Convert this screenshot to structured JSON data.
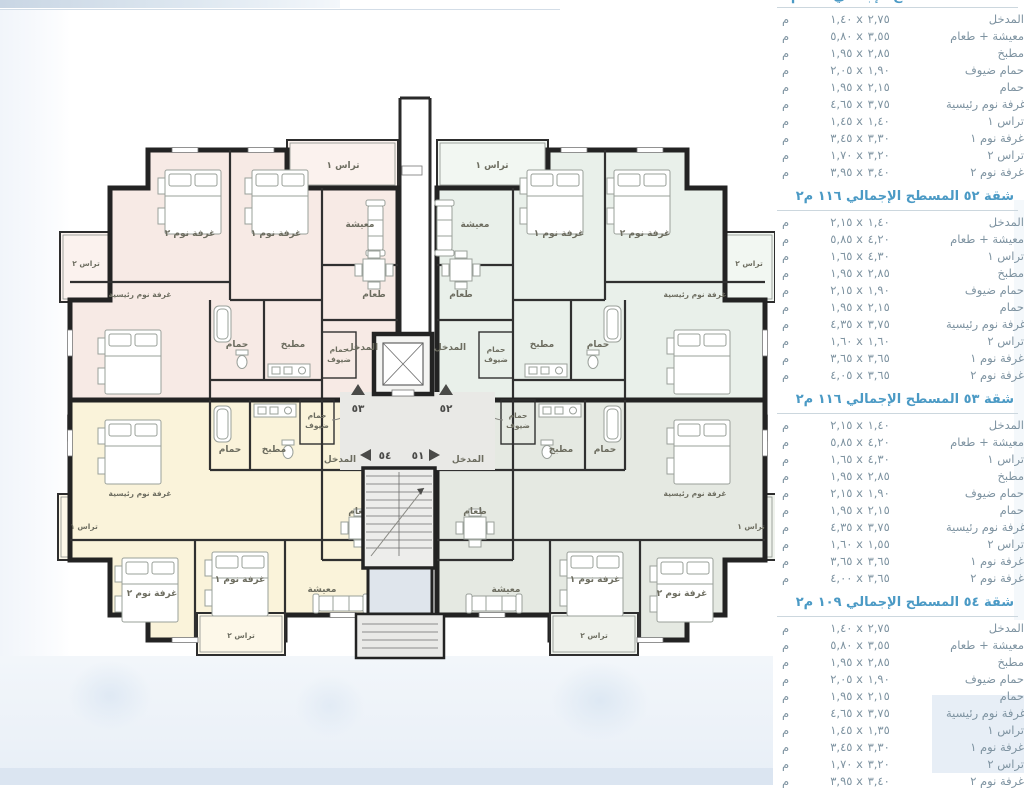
{
  "panel": {
    "unit_label": "م",
    "partial_heading": "شقة ٥١ المسطح الإجمالي ١٠٩ م٢",
    "sections": [
      {
        "heading": "",
        "rows": [
          {
            "name": "المدخل",
            "dims": "١,٤٠ x ٢,٧٥"
          },
          {
            "name": "معيشة + طعام",
            "dims": "٥,٨٠ x ٣,٥٥"
          },
          {
            "name": "مطبخ",
            "dims": "١,٩٥ x ٢,٨٥"
          },
          {
            "name": "حمام ضيوف",
            "dims": "٢,٠٥ x ١,٩٠"
          },
          {
            "name": "حمام",
            "dims": "١,٩٥ x ٢,١٥"
          },
          {
            "name": "غرفة نوم رئيسية",
            "dims": "٤,٦٥ x ٣,٧٥"
          },
          {
            "name": "تراس ١",
            "dims": "١,٤٥ x ١,٤٠"
          },
          {
            "name": "غرفة نوم ١",
            "dims": "٣,٤٥ x ٣,٣٠"
          },
          {
            "name": "تراس ٢",
            "dims": "١,٧٠ x ٣,٢٠"
          },
          {
            "name": "غرفة نوم ٢",
            "dims": "٣,٩٥ x ٣,٤٠"
          }
        ]
      },
      {
        "heading": "شقة ٥٢ المسطح الإجمالي ١١٦ م٢",
        "rows": [
          {
            "name": "المدخل",
            "dims": "٢,١٥ x ١,٤٠"
          },
          {
            "name": "معيشة + طعام",
            "dims": "٥,٨٥ x ٤,٢٠"
          },
          {
            "name": "تراس ١",
            "dims": "١,٦٥ x ٤,٣٠"
          },
          {
            "name": "مطبخ",
            "dims": "١,٩٥ x ٢,٨٥"
          },
          {
            "name": "حمام ضيوف",
            "dims": "٢,١٥ x ١,٩٠"
          },
          {
            "name": "حمام",
            "dims": "١,٩٥ x ٢,١٥"
          },
          {
            "name": "غرفة نوم رئيسية",
            "dims": "٤,٣٥ x ٣,٧٥"
          },
          {
            "name": "تراس ٢",
            "dims": "١,٦٠ x ١,٦٠"
          },
          {
            "name": "غرفة نوم ١",
            "dims": "٣,٦٥ x ٣,٦٥"
          },
          {
            "name": "غرفة نوم ٢",
            "dims": "٤,٠٥ x ٣,٦٥"
          }
        ]
      },
      {
        "heading": "شقة ٥٣ المسطح الإجمالي ١١٦ م٢",
        "rows": [
          {
            "name": "المدخل",
            "dims": "٢,١٥ x ١,٤٠"
          },
          {
            "name": "معيشة + طعام",
            "dims": "٥,٨٥ x ٤,٢٠"
          },
          {
            "name": "تراس ١",
            "dims": "١,٦٥ x ٤,٣٠"
          },
          {
            "name": "مطبخ",
            "dims": "١,٩٥ x ٢,٨٥"
          },
          {
            "name": "حمام ضيوف",
            "dims": "٢,١٥ x ١,٩٠"
          },
          {
            "name": "حمام",
            "dims": "١,٩٥ x ٢,١٥"
          },
          {
            "name": "غرفة نوم رئيسية",
            "dims": "٤,٣٥ x ٣,٧٥"
          },
          {
            "name": "تراس ٢",
            "dims": "١,٦٠ x ١,٥٥"
          },
          {
            "name": "غرفة نوم ١",
            "dims": "٣,٦٥ x ٣,٦٥"
          },
          {
            "name": "غرفة نوم ٢",
            "dims": "٤,٠٠ x ٣,٦٥"
          }
        ]
      },
      {
        "heading": "شقة ٥٤ المسطح الإجمالي ١٠٩ م٢",
        "rows": [
          {
            "name": "المدخل",
            "dims": "١,٤٠ x ٢,٧٥"
          },
          {
            "name": "معيشة + طعام",
            "dims": "٥,٨٠ x ٣,٥٥"
          },
          {
            "name": "مطبخ",
            "dims": "١,٩٥ x ٢,٨٥"
          },
          {
            "name": "حمام ضيوف",
            "dims": "٢,٠٥ x ١,٩٠"
          },
          {
            "name": "حمام",
            "dims": "١,٩٥ x ٢,١٥"
          },
          {
            "name": "غرفة نوم رئيسية",
            "dims": "٤,٦٥ x ٣,٧٥"
          },
          {
            "name": "تراس ١",
            "dims": "١,٤٥ x ١,٣٥"
          },
          {
            "name": "غرفة نوم ١",
            "dims": "٣,٤٥ x ٣,٣٠"
          },
          {
            "name": "تراس ٢",
            "dims": "١,٧٠ x ٣,٢٠"
          },
          {
            "name": "غرفة نوم ٢",
            "dims": "٣,٩٥ x ٣,٤٠"
          }
        ]
      }
    ]
  },
  "plan": {
    "room_labels": {
      "living": "معيشة",
      "dining": "طعام",
      "kitchen": "مطبخ",
      "bath": "حمام",
      "guest_bath_1": "حمام",
      "guest_bath_2": "ضيوف",
      "master": "غرفة نوم رئيسية",
      "bed1": "غرفة نوم ١",
      "bed2": "غرفة نوم ٢",
      "terrace1": "تراس ١",
      "terrace2": "تراس ٢",
      "entrance": "المدخل"
    },
    "unit_numbers": {
      "tl": "٥٣",
      "tr": "٥٢",
      "bl": "٥٤",
      "br": "٥١"
    }
  }
}
